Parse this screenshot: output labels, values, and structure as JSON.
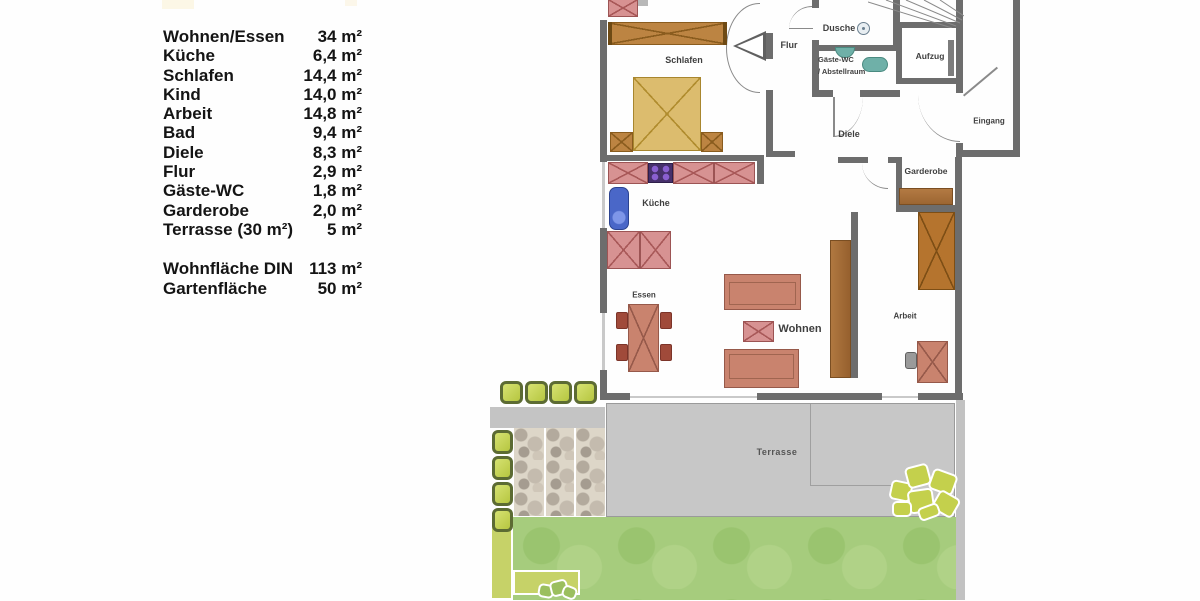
{
  "legend": {
    "rows": [
      {
        "label": "Wohnen/Essen",
        "value": "34 m²"
      },
      {
        "label": "Küche",
        "value": "6,4 m²"
      },
      {
        "label": "Schlafen",
        "value": "14,4 m²"
      },
      {
        "label": "Kind",
        "value": "14,0 m²"
      },
      {
        "label": "Arbeit",
        "value": "14,8 m²"
      },
      {
        "label": "Bad",
        "value": "9,4 m²"
      },
      {
        "label": "Diele",
        "value": "8,3 m²"
      },
      {
        "label": "Flur",
        "value": "2,9 m²"
      },
      {
        "label": "Gäste-WC",
        "value": "1,8 m²"
      },
      {
        "label": "Garderobe",
        "value": "2,0 m²"
      },
      {
        "label": "Terrasse (30 m²)",
        "value": "5 m²"
      }
    ],
    "summary": [
      {
        "label": "Wohnfläche DIN",
        "value": "113 m²"
      },
      {
        "label": "Gartenfläche",
        "value": "50 m²"
      }
    ]
  },
  "plan": {
    "rooms": {
      "schlafen": "Schlafen",
      "flur": "Flur",
      "dusche": "Dusche",
      "gaeste_wc": "Gäste-WC",
      "abstellraum": "/ Abstellraum",
      "aufzug": "Aufzug",
      "eingang": "Eingang",
      "diele": "Diele",
      "garderobe": "Garderobe",
      "kueche": "Küche",
      "essen": "Essen",
      "wohnen": "Wohnen",
      "arbeit": "Arbeit",
      "terrasse": "Terrasse"
    },
    "colors": {
      "wall": "#6d6d6d",
      "terrace_gray": "#c7c7c7",
      "grass_green": "#a6cc7d",
      "planter_green": "#c9d45c",
      "kitchen_pink": "#d79292",
      "bed_tan": "#dcbc6e",
      "wood_brown": "#ad6f2f",
      "sofa_terracotta": "#c9836e",
      "sink_blue": "#4a67c8",
      "fixture_teal": "#6fb0a8",
      "stove_purple": "#46306b"
    }
  }
}
